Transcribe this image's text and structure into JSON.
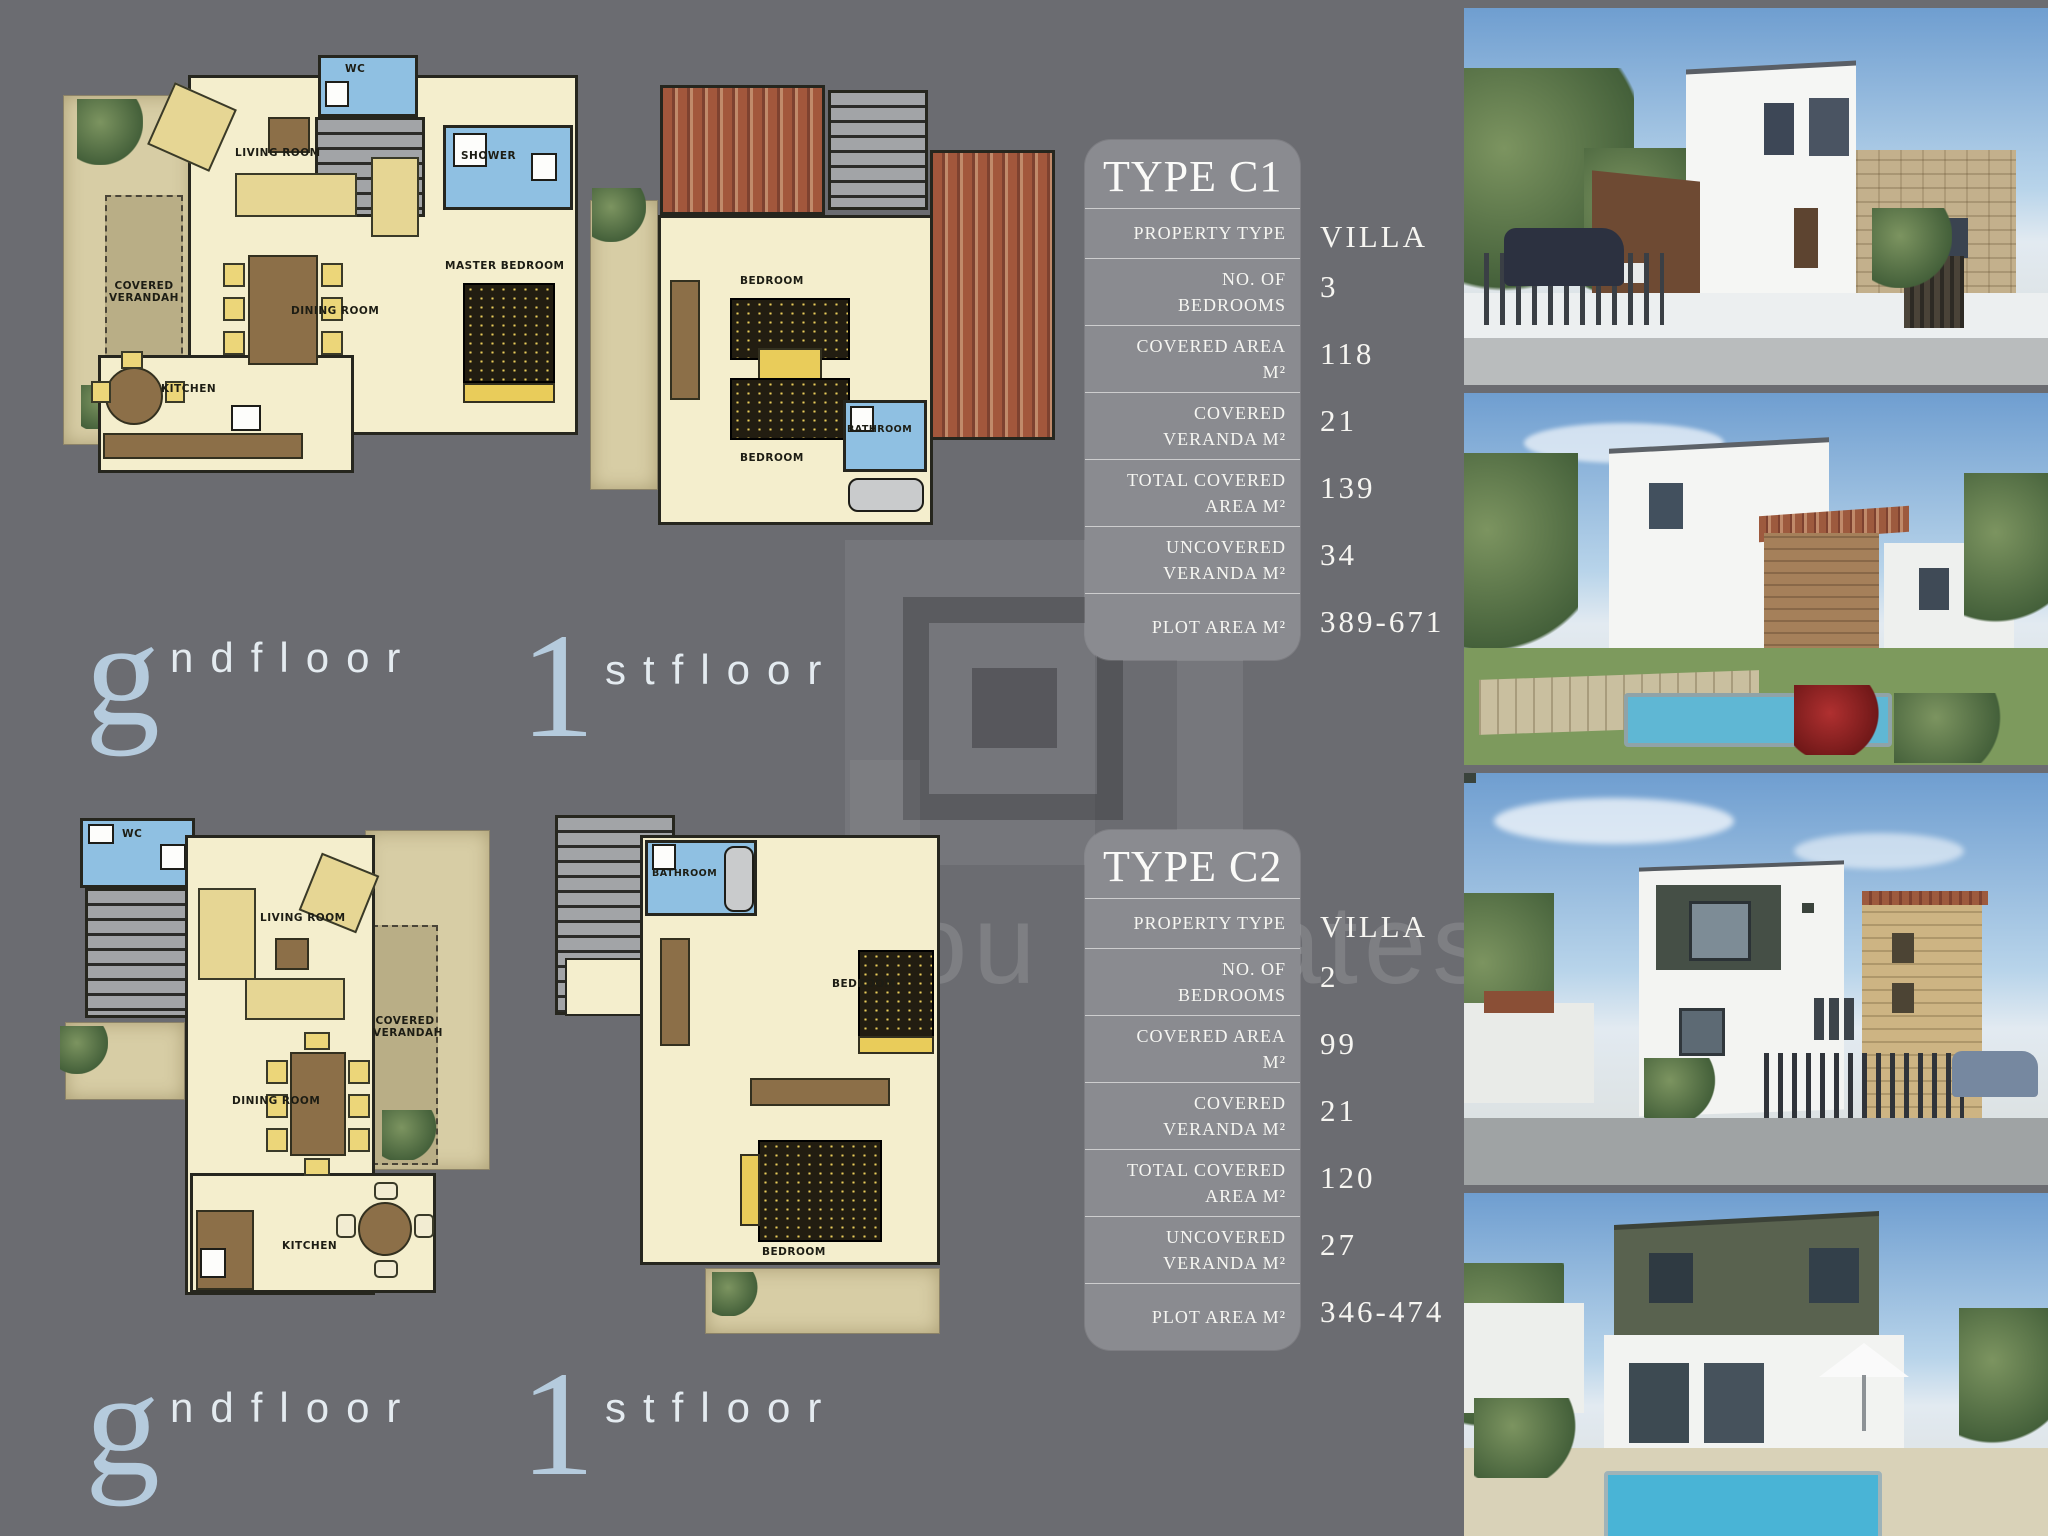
{
  "watermark": {
    "text": "ou Estates",
    "logo": "nested-square-logo"
  },
  "floor_labels": [
    {
      "big": "g",
      "rest": "ndfloor"
    },
    {
      "big": "1",
      "rest": "stfloor"
    },
    {
      "big": "g",
      "rest": "ndfloor"
    },
    {
      "big": "1",
      "rest": "stfloor"
    }
  ],
  "plans": {
    "c1_ground": {
      "rooms": {
        "veranda": "COVERED VERANDAH",
        "living": "LIVING ROOM",
        "wc": "WC",
        "shower": "SHOWER",
        "dining": "DINING ROOM",
        "master": "MASTER BEDROOM",
        "kitchen": "KITCHEN"
      }
    },
    "c1_first": {
      "rooms": {
        "bedroom_top": "BEDROOM",
        "bedroom_bottom": "BEDROOM",
        "bathroom": "BATHROOM"
      }
    },
    "c2_ground": {
      "rooms": {
        "wc": "WC",
        "living": "LIVING ROOM",
        "veranda": "COVERED VERANDAH",
        "dining": "DINING ROOM",
        "kitchen": "KITCHEN"
      }
    },
    "c2_first": {
      "rooms": {
        "bathroom": "BATHROOM",
        "bedroom_right": "BEDROOM",
        "bedroom_bottom": "BEDROOM"
      }
    }
  },
  "tables": [
    {
      "title": "TYPE C1",
      "rows": [
        {
          "label": "PROPERTY TYPE",
          "value": "VILLA"
        },
        {
          "label": "NO. OF BEDROOMS",
          "value": "3"
        },
        {
          "label": "COVERED AREA M²",
          "value": "118"
        },
        {
          "label": "COVERED VERANDA M²",
          "value": "21"
        },
        {
          "label": "TOTAL COVERED AREA M²",
          "value": "139"
        },
        {
          "label": "UNCOVERED VERANDA M²",
          "value": "34"
        },
        {
          "label": "PLOT AREA M²",
          "value": "389-671"
        }
      ]
    },
    {
      "title": "TYPE C2",
      "rows": [
        {
          "label": "PROPERTY TYPE",
          "value": "VILLA"
        },
        {
          "label": "NO. OF BEDROOMS",
          "value": "2"
        },
        {
          "label": "COVERED AREA M²",
          "value": "99"
        },
        {
          "label": "COVERED VERANDA M²",
          "value": "21"
        },
        {
          "label": "TOTAL COVERED AREA M²",
          "value": "120"
        },
        {
          "label": "UNCOVERED VERANDA M²",
          "value": "27"
        },
        {
          "label": "PLOT AREA M²",
          "value": "346-474"
        }
      ]
    }
  ],
  "colors": {
    "background": "#6b6c71",
    "panel": "#8a8b90",
    "cream_room": "#f4eecd",
    "wet_room": "#8fc0e2",
    "veranda": "#b9ae86",
    "roof_tile": "#a2573c",
    "accent_blue_letter": "#b5cbdd",
    "pool": "#55b4d6"
  }
}
